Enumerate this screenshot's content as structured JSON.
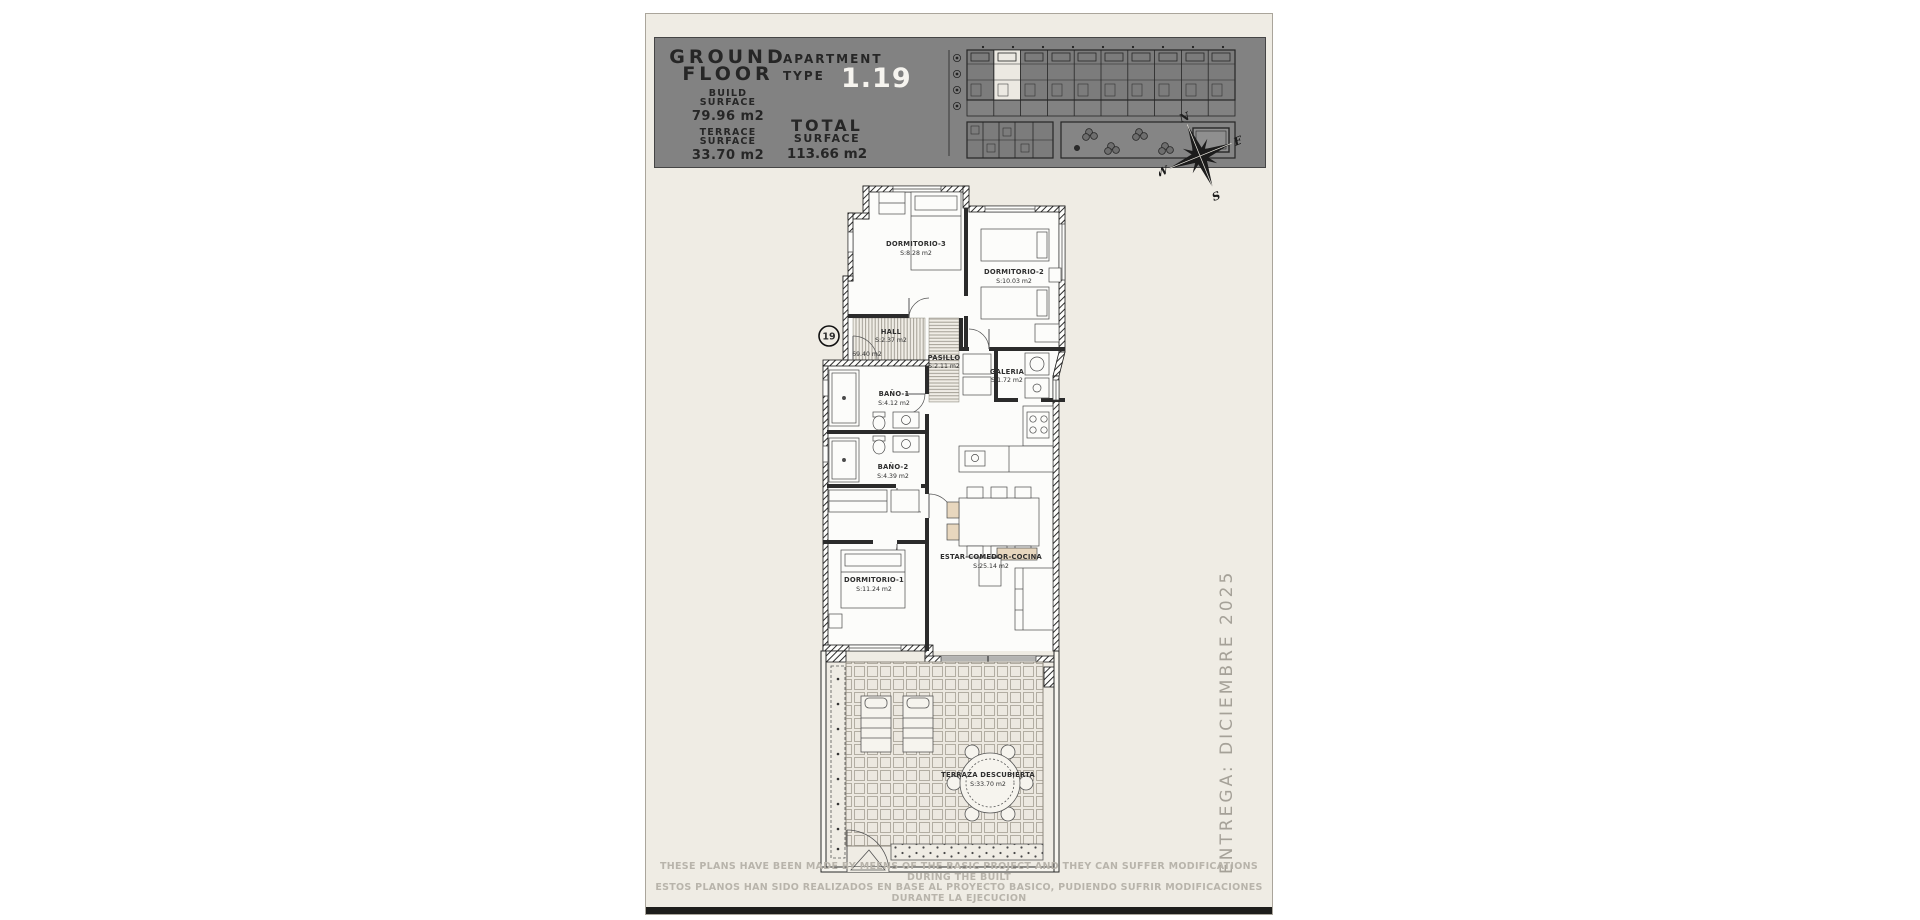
{
  "header": {
    "ground": "GROUND",
    "floor": "FLOOR",
    "apartment": "APARTMENT",
    "type": "TYPE",
    "apt_number": "1.19",
    "build_1": "BUILD",
    "build_2": "SURFACE",
    "build_value": "79.96 m2",
    "terrace_1": "TERRACE",
    "terrace_2": "SURFACE",
    "terrace_value": "33.70 m2",
    "total_1": "TOTAL",
    "total_2": "SURFACE",
    "total_value": "113.66 m2"
  },
  "compass": {
    "n": "N",
    "e": "E",
    "s": "S",
    "w": "W"
  },
  "plan": {
    "unit_badge": "19",
    "useful_area": "69.40 m2",
    "rooms": [
      {
        "name": "DORMITORIO-3",
        "area": "S:8.28 m2"
      },
      {
        "name": "DORMITORIO-2",
        "area": "S:10.03 m2"
      },
      {
        "name": "HALL",
        "area": "S:2.37 m2"
      },
      {
        "name": "PASILLO",
        "area": "S:2.11 m2"
      },
      {
        "name": "GALERIA",
        "area": "S:1.72 m2"
      },
      {
        "name": "BAÑO-1",
        "area": "S:4.12 m2"
      },
      {
        "name": "BAÑO-2",
        "area": "S:4.39 m2"
      },
      {
        "name": "DORMITORIO-1",
        "area": "S:11.24 m2"
      },
      {
        "name": "ESTAR-COMEDOR-COCINA",
        "area": "S:25.14 m2"
      },
      {
        "name": "TERRAZA DESCUBIERTA",
        "area": "S:33.70 m2"
      }
    ]
  },
  "delivery_note": "ENTREGA: DICIEMBRE 2025",
  "disclaimer": {
    "line1": "THESE PLANS HAVE BEEN MADE BY MEENS OF THE BASIC PROJECT AND THEY CAN SUFFER MODIFICATIONS DURING THE BUILT",
    "line2": "ESTOS PLANOS HAN SIDO REALIZADOS EN BASE AL PROYECTO BASICO, PUDIENDO SUFRIR MODIFICACIONES DURANTE LA EJECUCION"
  },
  "colors": {
    "page_bg": "#EFECE4",
    "header_bg": "#828282",
    "header_text": "#262626",
    "apartment_number_white": "#F6F4EF",
    "plan_line": "#1b1b1b",
    "muted_text": "#A5A198",
    "disclaimer_text": "#B8B4AB",
    "sand_accent": "#E8D7BE",
    "bottom_bar": "#1D1D1B"
  }
}
